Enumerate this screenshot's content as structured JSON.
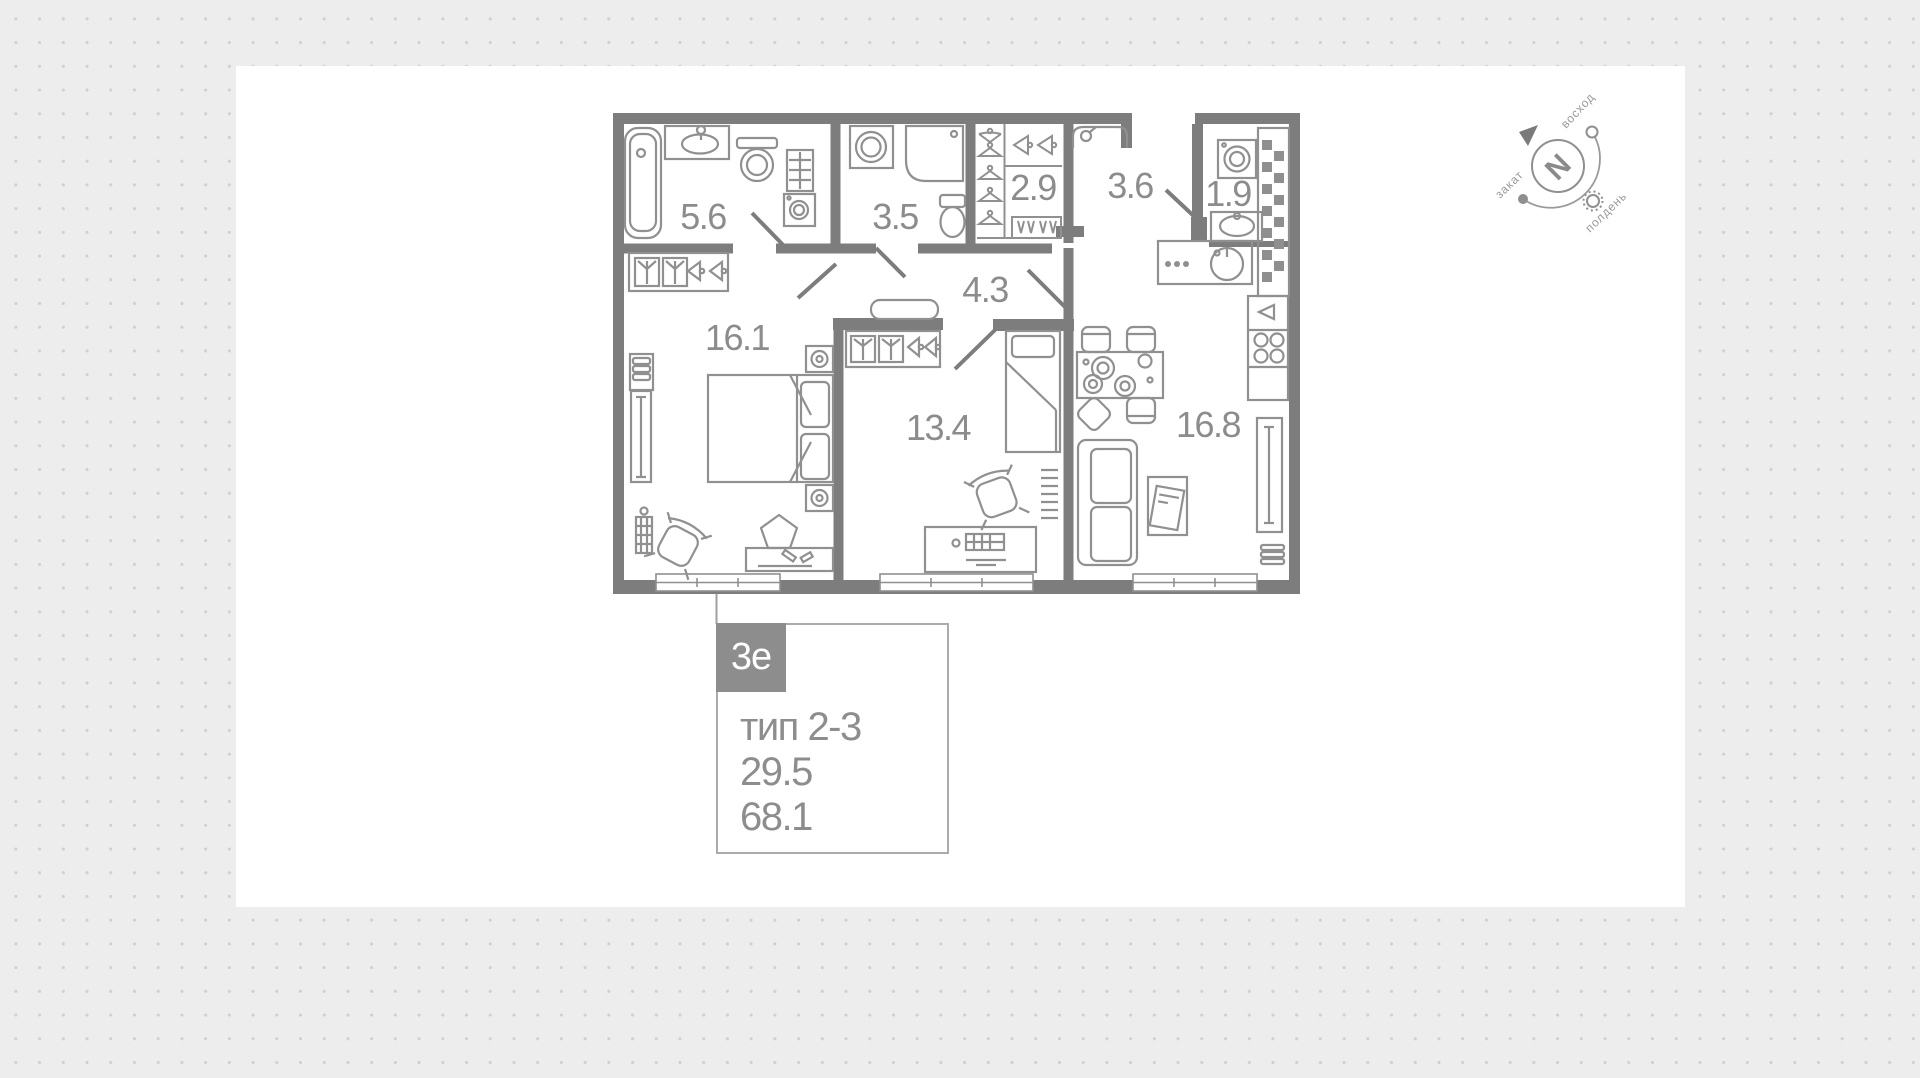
{
  "colors": {
    "background": "#ededed",
    "dot": "#d0d0d0",
    "panel": "#ffffff",
    "wall": "#7d7d7d",
    "fixture": "#909090",
    "label": "#8c8c8c",
    "badge_bg": "#8d8d8d",
    "badge_text": "#ffffff",
    "card_border": "#ababab"
  },
  "plan": {
    "rooms": [
      {
        "name": "bathroom",
        "area": "5.6"
      },
      {
        "name": "toilet",
        "area": "3.5"
      },
      {
        "name": "wardrobe",
        "area": "2.9"
      },
      {
        "name": "hall",
        "area": "3.6"
      },
      {
        "name": "laundry-wc",
        "area": "1.9"
      },
      {
        "name": "bedroom",
        "area": "16.1"
      },
      {
        "name": "corridor",
        "area": "4.3"
      },
      {
        "name": "bedroom-2",
        "area": "13.4"
      },
      {
        "name": "kitchen-living",
        "area": "16.8"
      }
    ]
  },
  "compass": {
    "north": "N",
    "sunrise": "восход",
    "sunset": "закат",
    "noon": "полдень"
  },
  "card": {
    "badge": "3е",
    "type": "тип 2-3",
    "area_living": "29.5",
    "area_total": "68.1"
  }
}
